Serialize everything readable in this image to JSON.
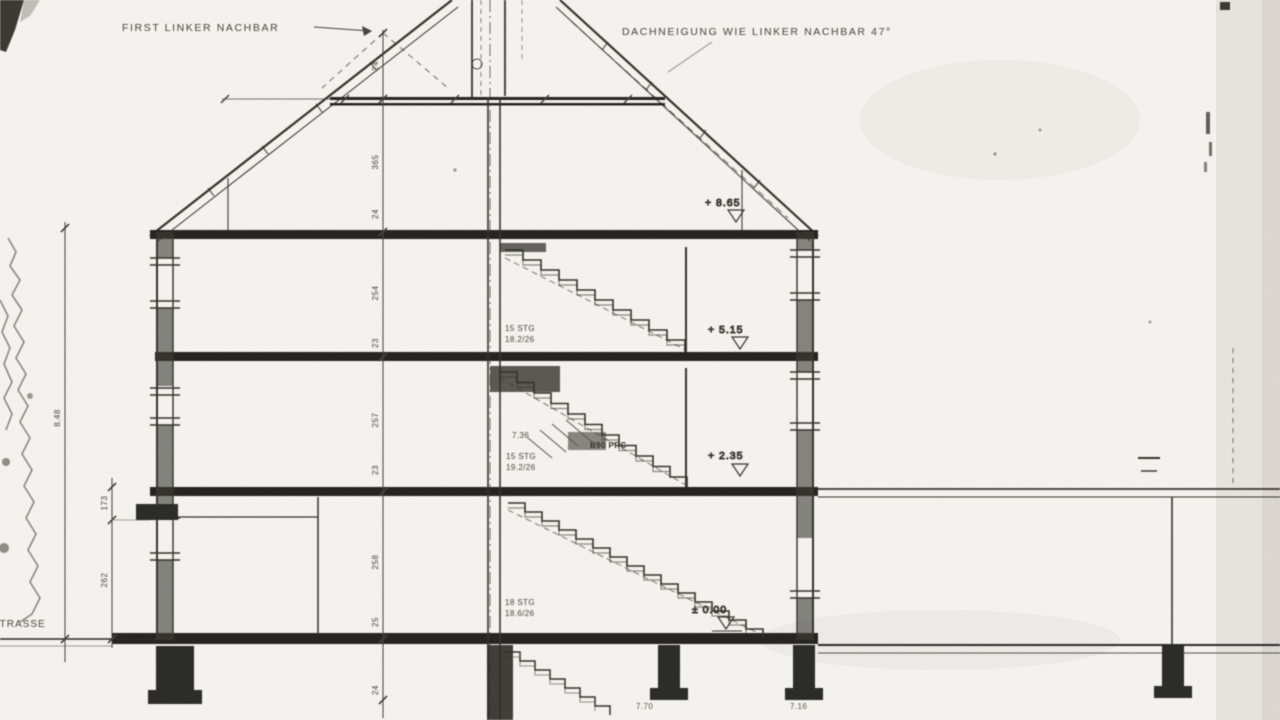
{
  "drawing": {
    "kind": "scanned building cross-section (Schnitt)",
    "labels": {
      "first_ridge_left_neighbor": "FIRST LINKER NACHBAR",
      "roof_pitch_note": "DACHNEIGUNG WIE LINKER NACHBAR 47°",
      "street": "STRASSE"
    },
    "levels": [
      {
        "name": "attic-floor",
        "text": "+ 8.65"
      },
      {
        "name": "second-floor",
        "text": "+ 5.15"
      },
      {
        "name": "first-floor",
        "text": "+ 2.35"
      },
      {
        "name": "ground-floor",
        "text": "± 0.00"
      }
    ],
    "stairs": {
      "upper": {
        "line1": "15 STG",
        "line2": "18.2/26"
      },
      "middle": {
        "height": "7.36",
        "line1": "15 STG",
        "line2": "19.2/26",
        "note": "B90 PRC"
      },
      "lower": {
        "line1": "18 STG",
        "line2": "18.6/26"
      }
    },
    "dimensions": {
      "main_chain": [
        "24",
        "365",
        "24",
        "254",
        "23",
        "257",
        "23",
        "258",
        "25",
        "24"
      ],
      "overall_left": "8.48",
      "left_small": [
        "173",
        "262"
      ],
      "footing_marks": [
        "7.70",
        "7.16"
      ]
    },
    "colors": {
      "ink": "#3b3733",
      "slab": "#262422",
      "paper": "#f5f3ef"
    }
  }
}
